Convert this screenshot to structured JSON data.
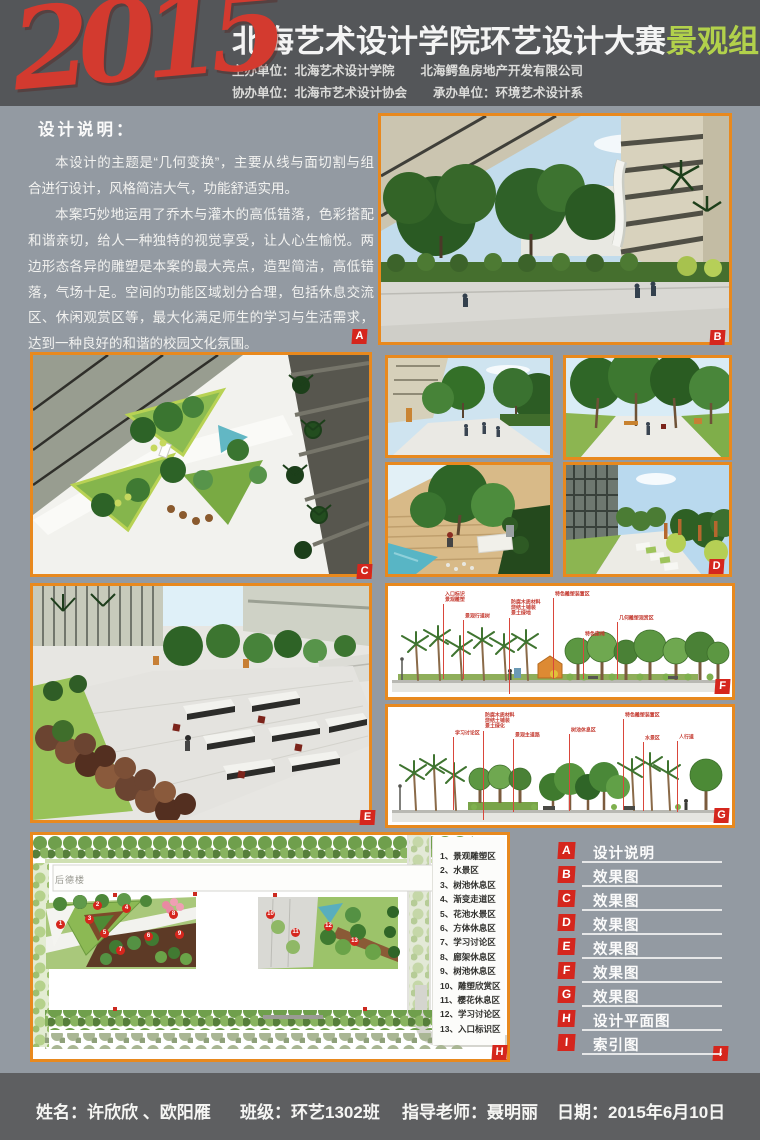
{
  "header": {
    "year_logo": "2015",
    "title": "北海艺术设计学院环艺设计大赛",
    "title_highlight": "景观组",
    "org_line1": [
      "主办单位：北海艺术设计学院",
      "北海鳄鱼房地产开发有限公司"
    ],
    "org_line2": [
      "协办单位：北海市艺术设计协会",
      "承办单位：环境艺术设计系"
    ]
  },
  "design_description": {
    "title": "设计说明：",
    "badge": "A",
    "paragraphs": [
      "本设计的主题是“几何变换”，主要从线与面切割与组合进行设计，风格简洁大气，功能舒适实用。",
      "本案巧妙地运用了乔木与灌木的高低错落，色彩搭配和谐亲切，给人一种独特的视觉享受，让人心生愉悦。两边形态各异的雕塑是本案的最大亮点，造型简洁，高低错落，气场十足。空间的功能区域划分合理，包括休息交流区、休闲观赏区等，最大化满足师生的学习与生活需求，达到一种良好的和谐的校园文化氛围。"
    ]
  },
  "renders": {
    "b_badge": "B",
    "c_badge": "C",
    "d_badge": "D",
    "e_badge": "E"
  },
  "sections": {
    "f": {
      "badge": "F",
      "annotations": [
        {
          "t": "入口标识\n景观雕塑",
          "x": 52,
          "y": 2,
          "h": 88
        },
        {
          "t": "景观行道树",
          "x": 72,
          "y": 24,
          "h": 66
        },
        {
          "t": "防腐木质材料\n烧结土铺装\n景土绿地",
          "x": 118,
          "y": 10,
          "h": 95
        },
        {
          "t": "特色雕塑装置区",
          "x": 162,
          "y": 2,
          "h": 88
        },
        {
          "t": "特色座椅",
          "x": 192,
          "y": 42,
          "h": 48
        },
        {
          "t": "几何雕塑观赏区",
          "x": 226,
          "y": 26,
          "h": 64
        }
      ]
    },
    "g": {
      "badge": "G",
      "annotations": [
        {
          "t": "学习讨论区",
          "x": 62,
          "y": 20,
          "h": 80
        },
        {
          "t": "防腐木质材料\n烧结土铺装\n景土绿化",
          "x": 92,
          "y": 2,
          "h": 108
        },
        {
          "t": "景观主道路",
          "x": 122,
          "y": 22,
          "h": 80
        },
        {
          "t": "树池休息区",
          "x": 178,
          "y": 17,
          "h": 84
        },
        {
          "t": "特色雕塑装置区",
          "x": 232,
          "y": 2,
          "h": 98
        },
        {
          "t": "水景区",
          "x": 252,
          "y": 25,
          "h": 76
        },
        {
          "t": "人行道",
          "x": 286,
          "y": 24,
          "h": 78
        }
      ]
    }
  },
  "plan": {
    "badge": "H",
    "building_label": "后德楼",
    "legend": [
      "1、景观雕塑区",
      "2、水景区",
      "3、树池休息区",
      "4、渐变走道区",
      "5、花池水景区",
      "6、方体休息区",
      "7、学习讨论区",
      "8、廊架休息区",
      "9、树池休息区",
      "10、雕塑欣赏区",
      "11、樱花休息区",
      "12、学习讨论区",
      "13、入口标识区"
    ],
    "markers": [
      {
        "n": "1",
        "x": 20,
        "y": 82
      },
      {
        "n": "2",
        "x": 57,
        "y": 63
      },
      {
        "n": "3",
        "x": 49,
        "y": 77
      },
      {
        "n": "4",
        "x": 86,
        "y": 66
      },
      {
        "n": "5",
        "x": 64,
        "y": 91
      },
      {
        "n": "6",
        "x": 108,
        "y": 94
      },
      {
        "n": "7",
        "x": 80,
        "y": 108
      },
      {
        "n": "8",
        "x": 133,
        "y": 72
      },
      {
        "n": "9",
        "x": 139,
        "y": 92
      },
      {
        "n": "10",
        "x": 230,
        "y": 72
      },
      {
        "n": "11",
        "x": 255,
        "y": 90
      },
      {
        "n": "12",
        "x": 288,
        "y": 84
      },
      {
        "n": "13",
        "x": 314,
        "y": 99
      }
    ]
  },
  "index_panel": {
    "corner_badge": "I",
    "items": [
      {
        "badge": "A",
        "label": "设计说明"
      },
      {
        "badge": "B",
        "label": "效果图"
      },
      {
        "badge": "C",
        "label": "效果图"
      },
      {
        "badge": "D",
        "label": "效果图"
      },
      {
        "badge": "E",
        "label": "效果图"
      },
      {
        "badge": "F",
        "label": "效果图"
      },
      {
        "badge": "G",
        "label": "效果图"
      },
      {
        "badge": "H",
        "label": "设计平面图"
      },
      {
        "badge": "I",
        "label": "索引图"
      }
    ]
  },
  "footer": {
    "name": "姓名：许欣欣 、欧阳雁",
    "class": "班级：环艺1302班",
    "teacher": "指导老师：聂明丽",
    "date": "日期：2015年6月10日"
  },
  "colors": {
    "accent_orange": "#e8891e",
    "badge_red": "#d5261d",
    "logo_red": "#d33a2f",
    "highlight_green": "#b2d14b",
    "body_bg": "#939aa2",
    "header_bg": "#545659",
    "footer_bg": "#5e5f61"
  }
}
